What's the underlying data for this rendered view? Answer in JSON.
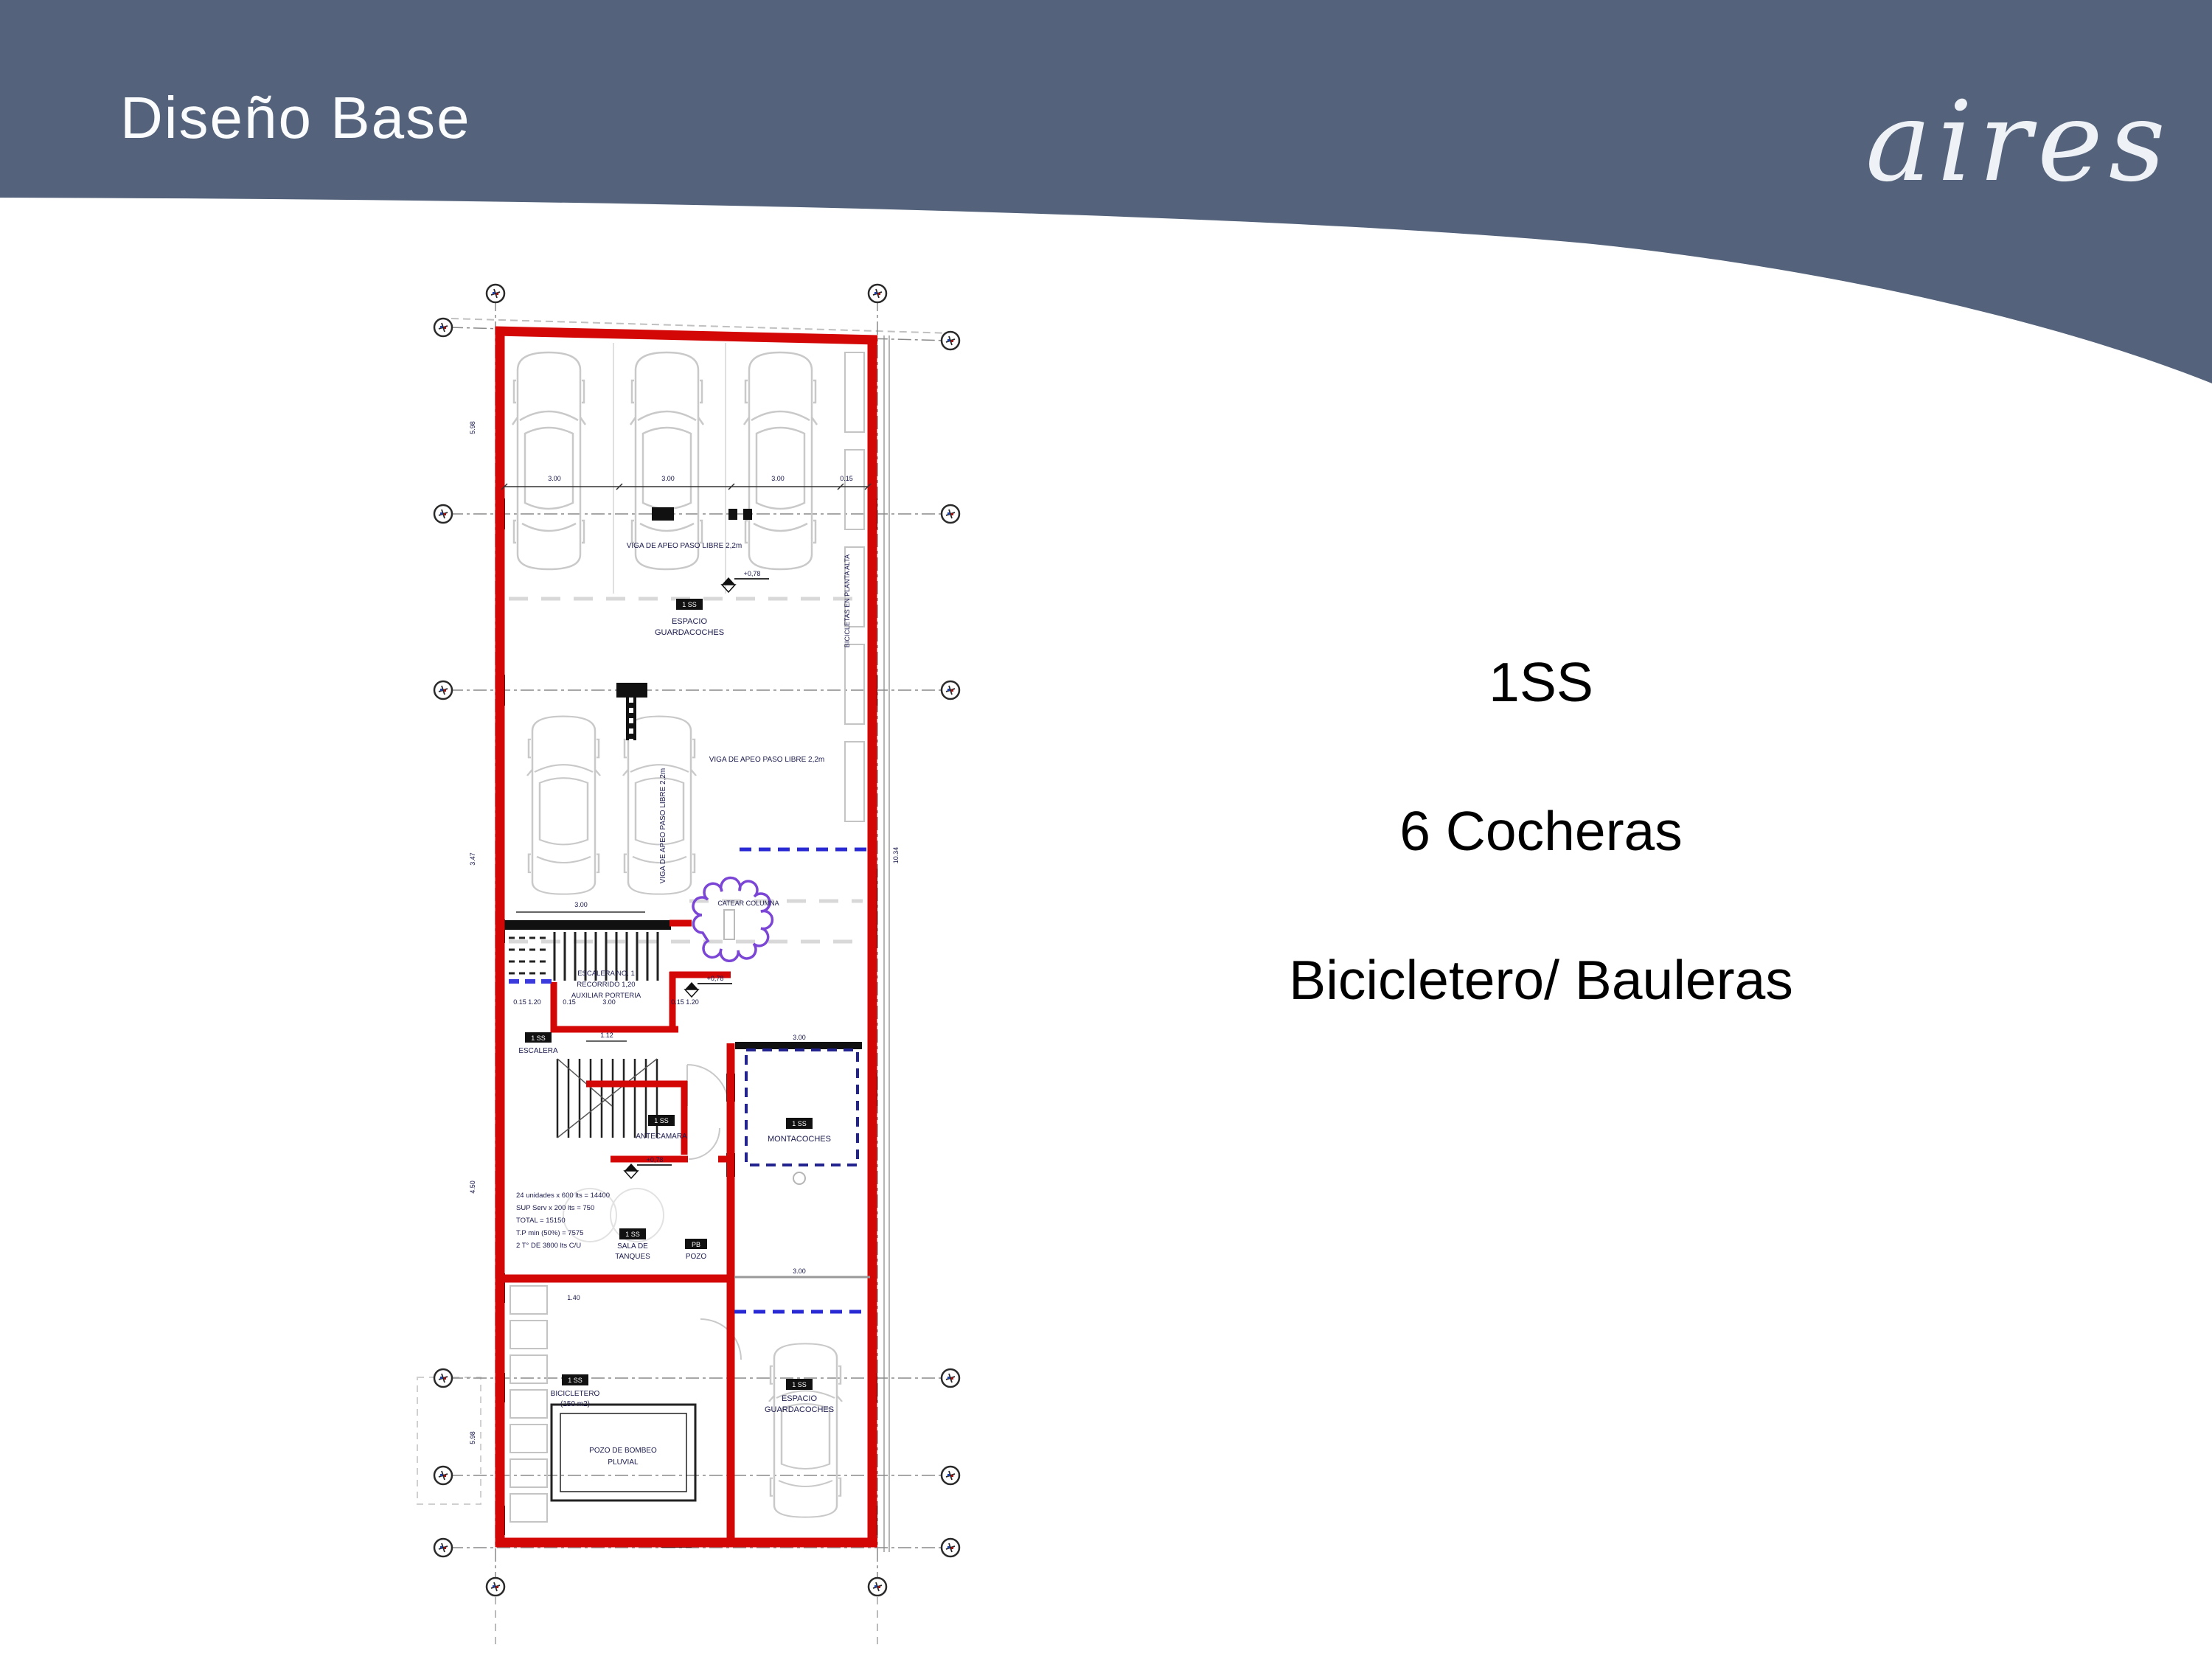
{
  "slide": {
    "title": "Diseño Base",
    "brand": "aires",
    "panel": {
      "line1": "1SS",
      "line2": "6 Cocheras",
      "line3": "Bicicletero/ Bauleras"
    },
    "colors": {
      "header_blue": "#54637b",
      "wall_red": "#d40707",
      "revision_purple": "#7b45d6",
      "dash_blue": "#2a2ad4",
      "text_black": "#000000"
    }
  },
  "plan": {
    "labels": {
      "unit_box": "1 SS",
      "espacio": "ESPACIO",
      "guardacoches": "GUARDACOCHES",
      "viga": "VIGA DE APEO PASO LIBRE 2,2m",
      "level": "+0,78",
      "catear": "CATEAR COLUMNA",
      "bicicletas": "BICICLETAS EN PLANTA ALTA",
      "escalera_no": "ESCALERA NO. 1",
      "recorrido": "RECORRIDO 1,20",
      "aux_porteria": "AUXILIAR PORTERIA",
      "escalera": "ESCALERA",
      "antecamara": "ANTECAMARA",
      "montacoches": "MONTACOCHES",
      "sala_de": "SALA DE",
      "tanques": "TANQUES",
      "pb_box": "PB",
      "pozo": "POZO",
      "bicicletero": "BICICLETERO",
      "bicicletero_m2": "(150 m2)",
      "pozo_bombeo": "POZO DE BOMBEO",
      "pluvial": "PLUVIAL"
    },
    "calc": [
      "24 unidades x 600 lts = 14400",
      "SUP Serv x 200 lts = 750",
      "TOTAL = 15150",
      "T.P min (50%) = 7575",
      "2 T° DE 3800 lts C/U"
    ],
    "dims": {
      "d300": "3.00",
      "d015": "0.15",
      "d112": "1.12",
      "d140": "1.40",
      "d015_120": "0.15 1.20",
      "v598": "5.98",
      "v347": "3.47",
      "v450": "4.50",
      "v1034": "10.34"
    }
  }
}
